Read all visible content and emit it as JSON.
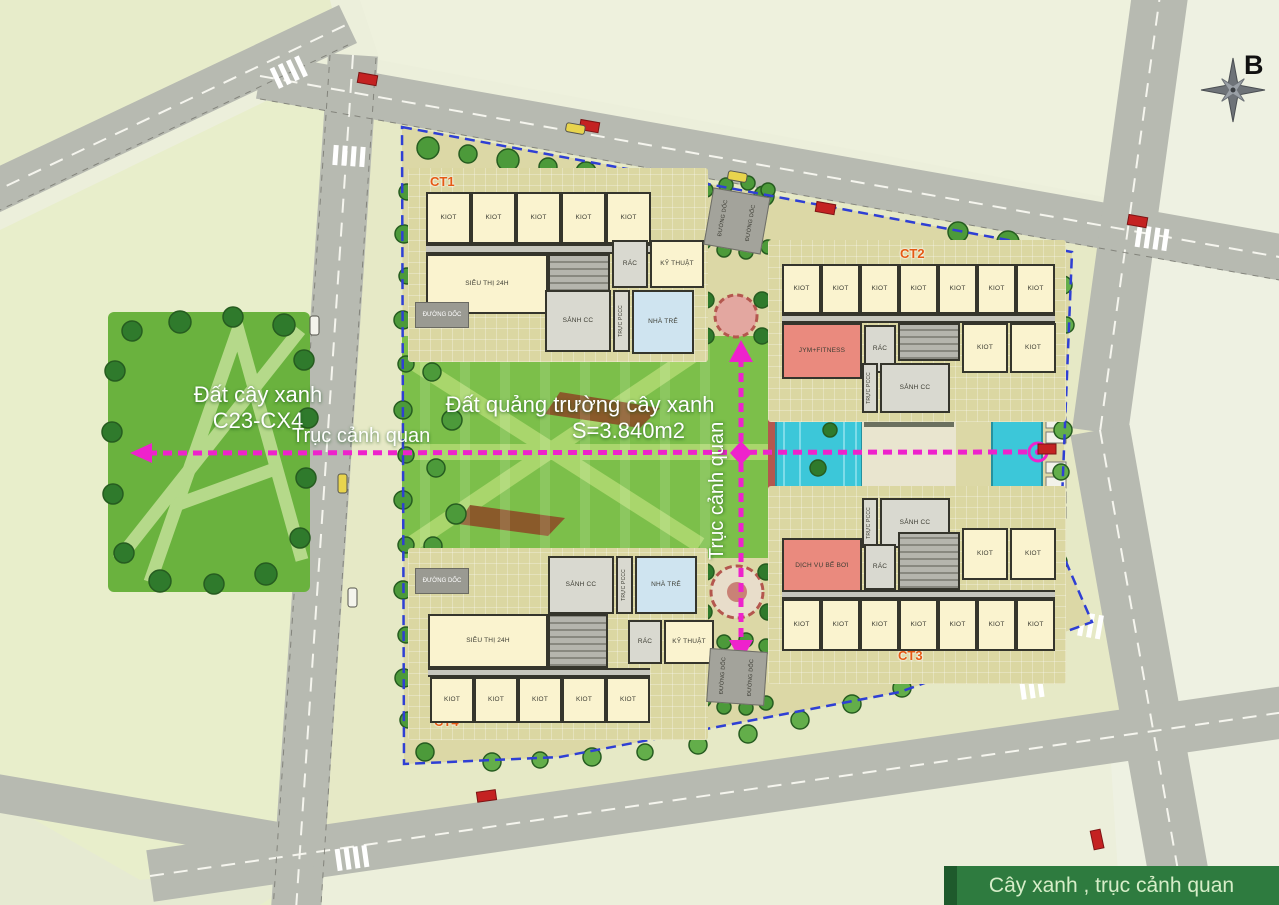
{
  "compass": {
    "label": "B"
  },
  "legend": {
    "label": "Cây xanh , trục cảnh quan"
  },
  "park": {
    "line1": "Đất cây xanh",
    "line2": "C23-CX4"
  },
  "plaza": {
    "line1": "Đất quảng trường cây xanh",
    "line2": "S=3.840m2"
  },
  "axis": {
    "horizontal": "Trục cảnh quan",
    "vertical": "Trục cảnh quan"
  },
  "rooms": {
    "kiot": "KIOT",
    "supermarket": "SIÊU THỊ 24H",
    "lobby": "SẢNH CC",
    "kindergarten": "NHÀ TRẺ",
    "technical": "KỸ THUẬT",
    "trash": "RÁC",
    "fire_watch": "TRỰC PCCC",
    "ramp": "ĐƯỜNG DỐC",
    "gym": "JYM+FITNESS",
    "pool_service": "DỊCH VỤ BỂ BƠI"
  },
  "buildings": {
    "ct1": {
      "label": "CT1"
    },
    "ct2": {
      "label": "CT2"
    },
    "ct3": {
      "label": "CT3"
    },
    "ct4": {
      "label": "CT4"
    }
  },
  "colors": {
    "axis_magenta": "#ee22cc",
    "boundary_blue": "#2f3fd4",
    "legend_green": "#2e7b3f",
    "ct_orange": "#e55a14",
    "pool_cyan": "#3cc7d9",
    "red_room": "#ea8a7e",
    "kindergarten_blue": "#cfe4f0"
  }
}
